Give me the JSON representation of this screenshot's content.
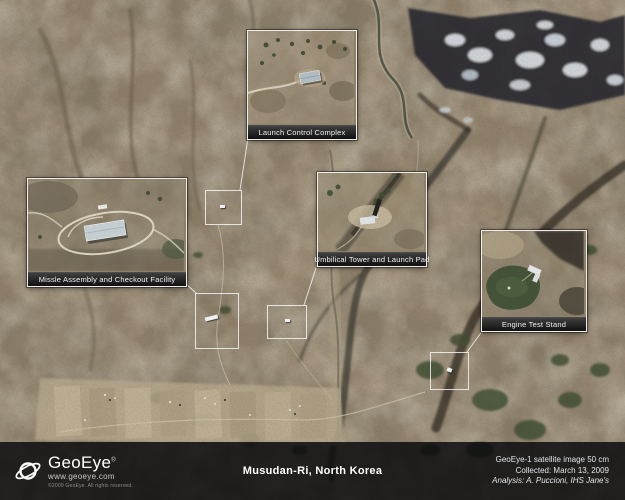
{
  "location": {
    "title": "Musudan-Ri, North Korea"
  },
  "branding": {
    "name": "GeoEye",
    "trademark": "®",
    "website": "www.geoeye.com",
    "copyright": "©2009 GeoEye. All rights reserved."
  },
  "credits": {
    "source": "GeoEye-1 satellite image 50 cm",
    "collected": "Collected: March 13, 2009",
    "analysis": "Analysis: A. Puccioni, IHS Jane's"
  },
  "callouts": [
    {
      "label": "Launch Control Complex"
    },
    {
      "label": "Missle Assembly and Checkout Facility"
    },
    {
      "label": "Umbilical Tower and Launch Pad"
    },
    {
      "label": "Engine Test Stand"
    }
  ],
  "colors": {
    "terrain_base": "#8d7c64",
    "annotation_border": "#ffffff",
    "label_bar": "#1a1a1a",
    "info_bar": "#0b0c0e",
    "snow": "#e7ecf1",
    "vegetation": "#3f5033"
  }
}
